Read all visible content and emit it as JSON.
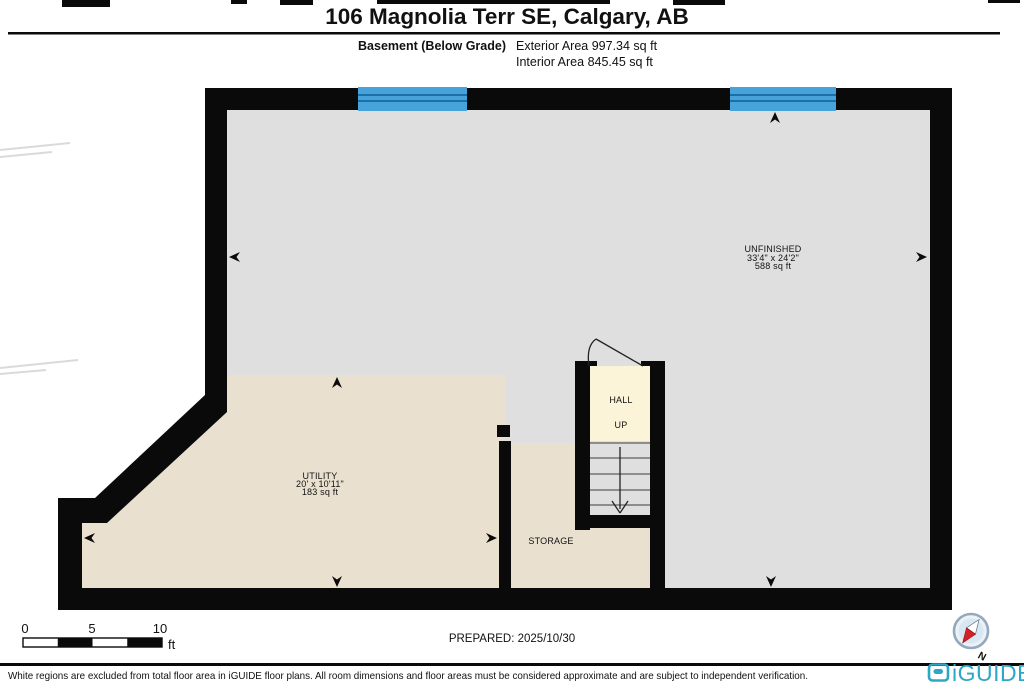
{
  "header": {
    "title": "106 Magnolia Terr SE, Calgary, AB",
    "floor_label": "Basement (Below Grade)",
    "exterior_area": "Exterior Area 997.34 sq ft",
    "interior_area": "Interior Area 845.45 sq ft"
  },
  "rooms": [
    {
      "name": "UNFINISHED",
      "dimensions": "33'4\" x 24'2\"",
      "area": "588 sq ft"
    },
    {
      "name": "UTILITY",
      "dimensions": "20' x 10'11\"",
      "area": "183 sq ft"
    },
    {
      "name": "HALL"
    },
    {
      "name": "UP"
    },
    {
      "name": "STORAGE"
    }
  ],
  "scale_bar": {
    "ticks": [
      "0",
      "5",
      "10"
    ],
    "unit": "ft"
  },
  "prepared_label": "PREPARED: 2025/10/30",
  "compass": {
    "north_label": "N"
  },
  "footer": {
    "disclaimer": "White regions are excluded from total floor area in iGUIDE floor plans. All room dimensions and floor areas must be considered approximate and are subject to independent verification.",
    "brand": "iGUIDE"
  },
  "colors": {
    "wall": "#0a0a0a",
    "floor_gray": "#dfdfdf",
    "floor_beige": "#e9e0cf",
    "floor_hall": "#fcf4d8",
    "window_blue": "#46a4da",
    "window_line": "#1d6fa8",
    "brand_teal": "#2da7c6",
    "compass_red": "#d42127"
  }
}
